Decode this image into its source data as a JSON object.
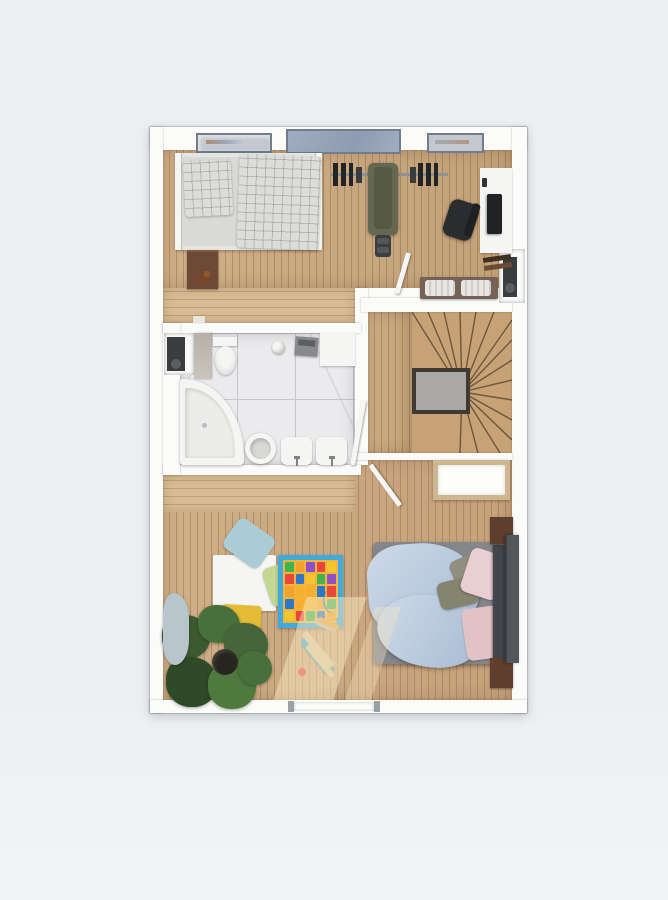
{
  "scene": {
    "type": "3d-floor-plan-top-view",
    "title": "upper floor plan rendering",
    "rooms": [
      {
        "name": "bedroom-gym-office",
        "items": [
          "single-bed",
          "checkered-pillow",
          "checkered-blanket",
          "nightstand",
          "wooden-toy",
          "barbell",
          "weight-plates",
          "weight-bench",
          "desk",
          "monitor",
          "keyboard",
          "office-chair",
          "desk-shelf",
          "open-door",
          "storage-bench",
          "bench-cushions",
          "radiator-niche",
          "window-left",
          "roof-window-middle",
          "window-right"
        ]
      },
      {
        "name": "hallway-landing",
        "items": [
          "doormat"
        ]
      },
      {
        "name": "bathroom",
        "items": [
          "concrete-partition",
          "toilet",
          "towel-shelf",
          "towel-roll",
          "vanity-cabinet",
          "corner-bathtub",
          "round-basin",
          "bidet",
          "washbasin",
          "door",
          "radiator-niche"
        ]
      },
      {
        "name": "stairwell",
        "items": [
          "winder-stairs",
          "stair-opening-railing",
          "landing"
        ]
      },
      {
        "name": "bedroom-nursery",
        "items": [
          "double-bed",
          "blue-duvet",
          "gray-pillows",
          "pink-pillows",
          "headboard",
          "nightstand-top",
          "nightstand-bottom",
          "tv-panel",
          "crib",
          "kids-table",
          "kids-chair-blue",
          "kids-chair-green",
          "kids-chair-yellow",
          "play-mat",
          "toy-airplane",
          "toy-airplane-small",
          "potted-plant",
          "beanbag",
          "sunlight-patches",
          "window-bottom",
          "door"
        ]
      }
    ]
  },
  "colors": {
    "page_bg": "#edeff1",
    "page_bg2": "#f3f4f6",
    "wall": "#fbfbfa",
    "wall_edge": "#d8dadc",
    "door": "#f6f6f4",
    "wood": "#cda97e",
    "wood_hall": "#d9bc93",
    "stair_wood": "#c7a276",
    "stair_line": "#6e573c",
    "void_frame": "#3f3a33",
    "void_fill": "#aaa8a5",
    "marble": "#ebebed",
    "grout": "#c3c6ca",
    "furn_white": "#f5f5f3",
    "bedding": "#dcdcda",
    "bed_frame": "#e5e5e3",
    "nightstand": "#6e4a36",
    "nightstand_dark": "#5e3e2c",
    "toy_brown": "#7a4526",
    "olive_bench": "#646851",
    "olive_dark": "#555944",
    "equip_black": "#232426",
    "equip_gray": "#909296",
    "chair_black": "#2b2c2e",
    "monitor": "#202224",
    "shelf_dark": "#40301f",
    "shelf_mid": "#6b4c32",
    "bench_brown": "#756255",
    "cushion_light": "#e8e6e2",
    "radiator": "#3a3d40",
    "radiator_hi": "#5a5e62",
    "glass_blue": "#9fadc0",
    "glass_light": "#c4c9cf",
    "frame_gray": "#717d8c",
    "concrete": "#b5b1a9",
    "tub_inner": "#ececea",
    "bed_base": "#85878a",
    "headboard": "#43454a",
    "duvet1": "#cdd9e8",
    "duvet2": "#a9bcd4",
    "pillow_gray1": "#8f8e80",
    "pillow_gray2": "#85846f",
    "pillow_pink1": "#e9cfd1",
    "pillow_pink2": "#e2c3c5",
    "tv_panel": "#53565a",
    "crib_frame": "#cdb691",
    "chair_blue": "#a9ccd5",
    "chair_green": "#c4d795",
    "chair_yellow": "#e5bc35",
    "chair_yellow_dark": "#d0a72b",
    "mat_border": "#3fabdc",
    "mat_bg": "#f4b43c",
    "moon_blue": "#3a80c2",
    "plane_blue": "#3ea4d8",
    "plane_wing": "#d9c49a",
    "plane_red": "#d6483a",
    "plant1": "#3c5a31",
    "plant2": "#49703b",
    "plant3": "#2f4a28",
    "plant4": "#44663a",
    "plant5": "#4e7a3f",
    "pot": "#28251f",
    "beanbag": "#b9c5cd",
    "sun": "#f8e7c2",
    "window_post": "#9aa0a4"
  },
  "play_mat": {
    "tiles": [
      "#3db54a",
      "#f0a12e",
      "#8e4fc8",
      "#e8473c",
      "#f3c52f",
      "#e8473c",
      "#2e77c8",
      "#f3c52f",
      "#3db54a",
      "#8e4fc8",
      "#f0a12e",
      "#f6b02f",
      "#f6b02f",
      "#2e77c8",
      "#e8473c",
      "#2e77c8",
      "#f6b02f",
      "#f6b02f",
      "#f0a12e",
      "#3db54a",
      "#f3c52f",
      "#e8473c",
      "#3db54a",
      "#2e77c8",
      "#f0a12e"
    ]
  }
}
